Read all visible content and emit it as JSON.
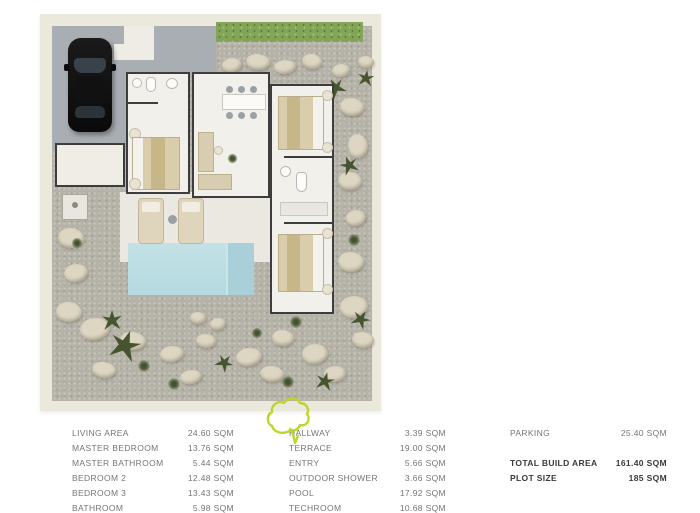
{
  "plan": {
    "name": "villa-top-view-floor-plan",
    "colors": {
      "plan_border": "#ebe8dc",
      "parking": "#a9aeb3",
      "gravel": "#b5b2a7",
      "stepping_stone": "#ddd6c2",
      "hedge": "#82a557",
      "room_wall": "#3d3d3d",
      "room_floor": "#f2f0ea",
      "terrace": "#eae8e0",
      "pool": "#bcdde2",
      "bed": "#d9cdab",
      "car": "#121212",
      "plant": "#46552f"
    }
  },
  "annotation": {
    "name": "hand-drawn-highlight-scribble",
    "color": "#bdd52c"
  },
  "legend": {
    "columns": [
      {
        "rows": [
          {
            "label": "LIVING AREA",
            "value": "24.60 SQM"
          },
          {
            "label": "MASTER BEDROOM",
            "value": "13.76 SQM"
          },
          {
            "label": "MASTER BATHROOM",
            "value": "5.44 SQM"
          },
          {
            "label": "BEDROOM 2",
            "value": "12.48 SQM"
          },
          {
            "label": "BEDROOM 3",
            "value": "13.43 SQM"
          },
          {
            "label": "BATHROOM",
            "value": "5.98 SQM"
          }
        ]
      },
      {
        "rows": [
          {
            "label": "HALLWAY",
            "value": "3.39 SQM"
          },
          {
            "label": "TERRACE",
            "value": "19.00 SQM"
          },
          {
            "label": "ENTRY",
            "value": "5.66 SQM"
          },
          {
            "label": "OUTDOOR SHOWER",
            "value": "3.66 SQM"
          },
          {
            "label": "POOL",
            "value": "17.92 SQM"
          },
          {
            "label": "TECHROOM",
            "value": "10.68 SQM"
          }
        ]
      },
      {
        "rows": [
          {
            "label": "PARKING",
            "value": "25.40 SQM"
          },
          {
            "label": "",
            "value": ""
          },
          {
            "label": "TOTAL BUILD AREA",
            "value": "161.40 SQM"
          },
          {
            "label": "PLOT SIZE",
            "value": "185 SQM"
          }
        ]
      }
    ]
  }
}
